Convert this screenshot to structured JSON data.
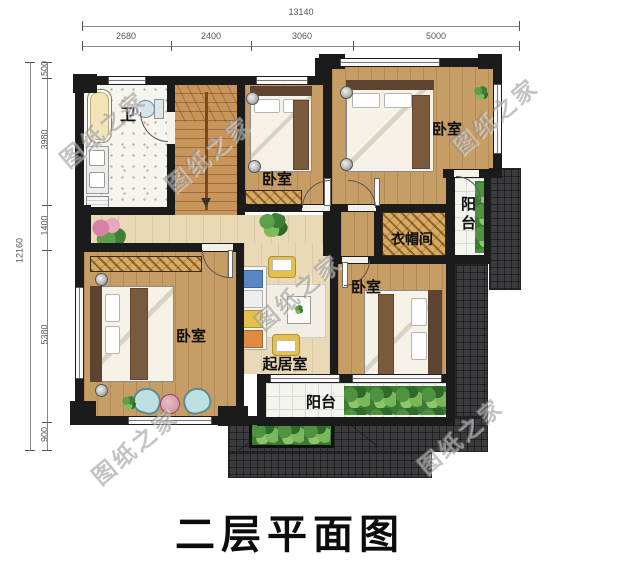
{
  "title": "二层平面图",
  "watermark": "图纸之家",
  "dims": {
    "top_total": "13140",
    "top_segments": [
      "2680",
      "2400",
      "3060",
      "5000"
    ],
    "left_total": "12160",
    "left_segments": [
      "500",
      "3980",
      "1400",
      "5380",
      "900"
    ]
  },
  "rooms": {
    "bathroom": "卫",
    "bedroom_mid": "卧室",
    "bedroom_top_right": "卧室",
    "bedroom_bottom_right": "卧室",
    "bedroom_bottom_left": "卧室",
    "cloakroom": "衣帽间",
    "living_room": "起居室",
    "balcony_right": "阳台",
    "balcony_bottom": "阳台"
  },
  "colors": {
    "wall": "#1b1b1b",
    "bedroom_floor": "#c79d66",
    "hall_floor": "#ead9b6",
    "roof_tile": "#3b3b3e",
    "balcony_tile": "#f4f4f1",
    "wardrobe_hatch": "#d9ab62",
    "label_text": "#0e0e0e",
    "watermark_gray": "#7a7a7a"
  }
}
